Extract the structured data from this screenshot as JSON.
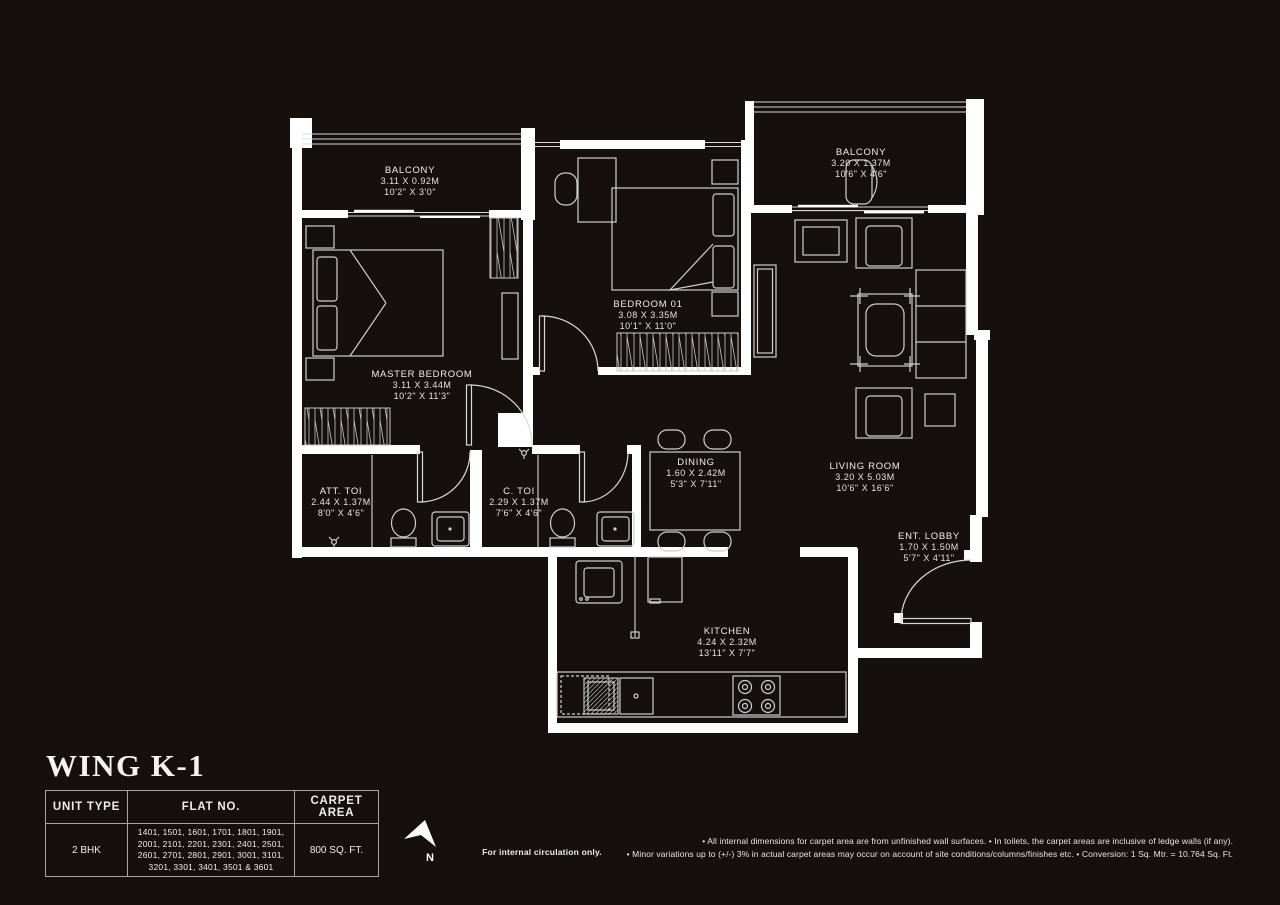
{
  "page": {
    "background": "#15100e",
    "line_color": "#ffffff"
  },
  "title": {
    "text": "WING K-1"
  },
  "plan": {
    "rooms": [
      {
        "id": "balcony-left",
        "name": "BALCONY",
        "dims_m": "3.11 X 0.92M",
        "dims_ft": "10'2\" X 3'0\""
      },
      {
        "id": "balcony-right",
        "name": "BALCONY",
        "dims_m": "3.20 X 1.37M",
        "dims_ft": "10'6\" X 4'6\""
      },
      {
        "id": "master-bedroom",
        "name": "MASTER BEDROOM",
        "dims_m": "3.11 X 3.44M",
        "dims_ft": "10'2\" X 11'3\""
      },
      {
        "id": "bedroom-01",
        "name": "BEDROOM 01",
        "dims_m": "3.08 X 3.35M",
        "dims_ft": "10'1\" X 11'0\""
      },
      {
        "id": "living-room",
        "name": "LIVING ROOM",
        "dims_m": "3.20 X 5.03M",
        "dims_ft": "10'6\" X 16'6\""
      },
      {
        "id": "dining",
        "name": "DINING",
        "dims_m": "1.60 X 2.42M",
        "dims_ft": "5'3\" X 7'11\""
      },
      {
        "id": "att-toi",
        "name": "ATT. TOI",
        "dims_m": "2.44 X 1.37M",
        "dims_ft": "8'0\" X 4'6\""
      },
      {
        "id": "c-toi",
        "name": "C. TOI",
        "dims_m": "2.29 X 1.37M",
        "dims_ft": "7'6\" X 4'6\""
      },
      {
        "id": "ent-lobby",
        "name": "ENT. LOBBY",
        "dims_m": "1.70 X 1.50M",
        "dims_ft": "5'7\" X 4'11\""
      },
      {
        "id": "kitchen",
        "name": "KITCHEN",
        "dims_m": "4.24 X 2.32M",
        "dims_ft": "13'11\" X 7'7\""
      }
    ]
  },
  "compass": {
    "label": "N"
  },
  "summary_table": {
    "headers": [
      "UNIT TYPE",
      "FLAT NO.",
      "CARPET AREA"
    ],
    "rows": [
      {
        "unit_type": "2 BHK",
        "flat_no": "1401, 1501, 1601, 1701, 1801, 1901, 2001, 2101, 2201, 2301, 2401, 2501, 2601, 2701, 2801, 2901, 3001, 3101, 3201, 3301, 3401, 3501 & 3601",
        "carpet_area": "800 SQ. FT."
      }
    ]
  },
  "notes": {
    "circulation": "For internal circulation only.",
    "disclaimer_line1": "• All internal dimensions for carpet area are from unfinished wall surfaces. • In toilets, the carpet areas are inclusive of ledge walls (if any).",
    "disclaimer_line2": "• Minor variations up to (+/-) 3% in actual carpet areas may occur on account of site conditions/columns/finishes etc. • Conversion: 1 Sq. Mtr. = 10.764 Sq. Ft."
  }
}
